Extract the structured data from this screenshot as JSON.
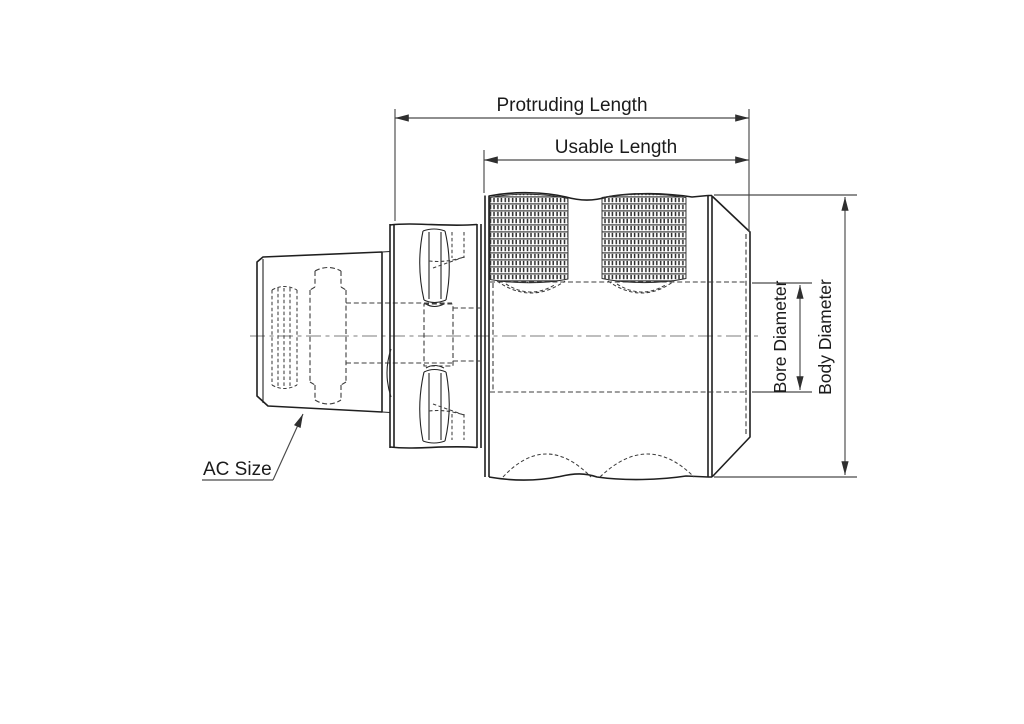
{
  "drawing": {
    "kind": "tool-holder-technical-drawing-side-view",
    "labels": {
      "protruding_length": "Protruding Length",
      "usable_length": "Usable Length",
      "bore_diameter": "Bore Diameter",
      "body_diameter": "Body Diameter",
      "ac_size": "AC Size"
    },
    "colors": {
      "background": "#ffffff",
      "object_line": "#1f1f1f",
      "hidden_line": "#3d3d3d",
      "dimension_line": "#4a4a4a",
      "centerline": "#979797",
      "text": "#1b1b1b"
    }
  }
}
